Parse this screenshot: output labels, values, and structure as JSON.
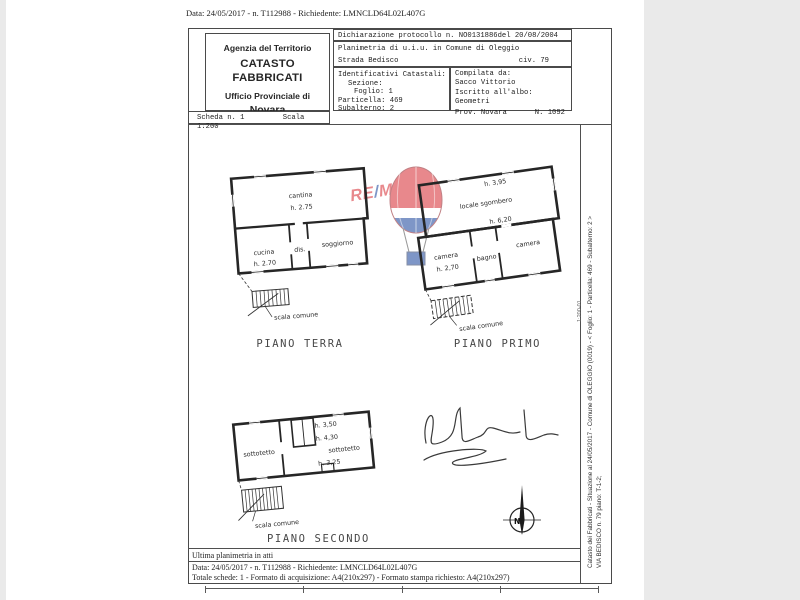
{
  "document": {
    "top_line": "Data: 24/05/2017 - n. T112988 - Richiedente: LMNCLD64L02L407G",
    "header": {
      "agency": {
        "line1": "Agenzia del Territorio",
        "line2": "CATASTO FABBRICATI",
        "line3": "Ufficio Provinciale di",
        "line4": "Novara"
      },
      "scheda": "Scheda n. 1",
      "scala": "Scala 1:200",
      "protocol": "Dichiarazione protocollo n. NO0131886del  20/08/2004",
      "planimetria": "Planimetria di u.i.u. in Comune di Oleggio",
      "street": "Strada Bedisco",
      "civico": "civ. 79",
      "catastali": {
        "title": "Identificativi Catastali:",
        "sezione": "Sezione:",
        "foglio": "Foglio: 1",
        "particella": "Particella: 469",
        "subalterno": "Subalterno: 2"
      },
      "compiler": {
        "label": "Compilata da:",
        "name": "Sacco Vittorio",
        "albo_label": "Iscritto all'albo:",
        "albo": "Geometri",
        "prov": "Prov. Novara",
        "num": "N. 1092"
      }
    },
    "plans": {
      "terra": {
        "title": "PIANO TERRA",
        "cantina": "cantina",
        "cantina_h": "h. 2.75",
        "cucina": "cucina",
        "cucina_h": "h. 2.70",
        "dis": "dis.",
        "soggiorno": "soggiorno",
        "scala_comune": "scala comune"
      },
      "primo": {
        "title": "PIANO PRIMO",
        "locale": "locale sgombero",
        "h_top": "h. 3,95",
        "h_mid": "h. 6,20",
        "camera1": "camera",
        "camera1_h": "h. 2,70",
        "bagno": "bagno",
        "camera2": "camera",
        "scala_comune": "scala comune"
      },
      "secondo": {
        "title": "PIANO SECONDO",
        "sottotetto1": "sottotetto",
        "sottotetto2": "sottotetto",
        "h1": "h. 3,50",
        "h2": "h. 4,30",
        "h3": "h. 3,25",
        "scala_comune": "scala comune"
      }
    },
    "compass_label": "N",
    "margin": {
      "line1": "Catasto dei Fabbricati - Situazione al 24/05/2017 - Comune di OLEGGIO (0019) - < Foglio: 1 - Particella: 469 - Subalterno: 2 >",
      "line2": "VIA BEDISCO n. 79 piano: T-1-2;",
      "stamp": "1:200-01"
    },
    "footer": {
      "ultima": "Ultima planimetria in atti",
      "data_line": "Data: 24/05/2017 - n. T112988 - Richiedente: LMNCLD64L02L407G",
      "totale_line": "Totale schede: 1 - Formato di acquisizione: A4(210x297)  - Formato stampa richiesto: A4(210x297)"
    }
  },
  "watermark": {
    "re": "RE",
    "slash": "/",
    "max": "MAX",
    "red": "#d7282f",
    "blue": "#16419b"
  }
}
